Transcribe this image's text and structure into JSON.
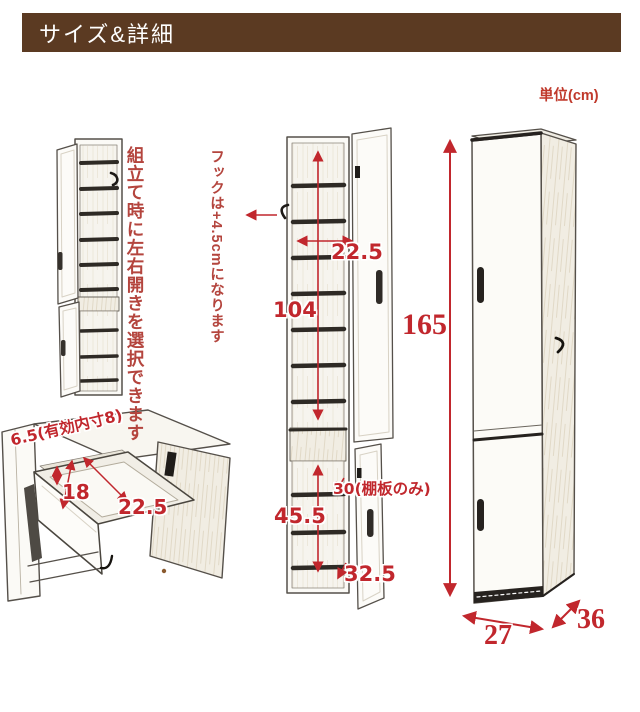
{
  "header": {
    "title": "サイズ&詳細"
  },
  "unit_label": "単位(cm)",
  "notes": {
    "assembly": "組立て時に左右開きを選択できます",
    "hook": "フックは+4.5cmになります"
  },
  "dimensions": {
    "mid_shelf_width": "22.5",
    "upper_height": "104",
    "lower_height": "45.5",
    "shelf_board": "30(棚板のみ)",
    "bottom_width": "32.5",
    "total_height": "165",
    "width": "27",
    "depth": "36",
    "drawer_height": "6.5(有効内寸8)",
    "drawer_width": "18",
    "drawer_depth": "22.5"
  },
  "colors": {
    "header_bg": "#5b3a22",
    "header_text": "#ffffff",
    "dimension_red": "#c1272d",
    "note_red": "#b4453e",
    "line_art": "#55504a"
  }
}
